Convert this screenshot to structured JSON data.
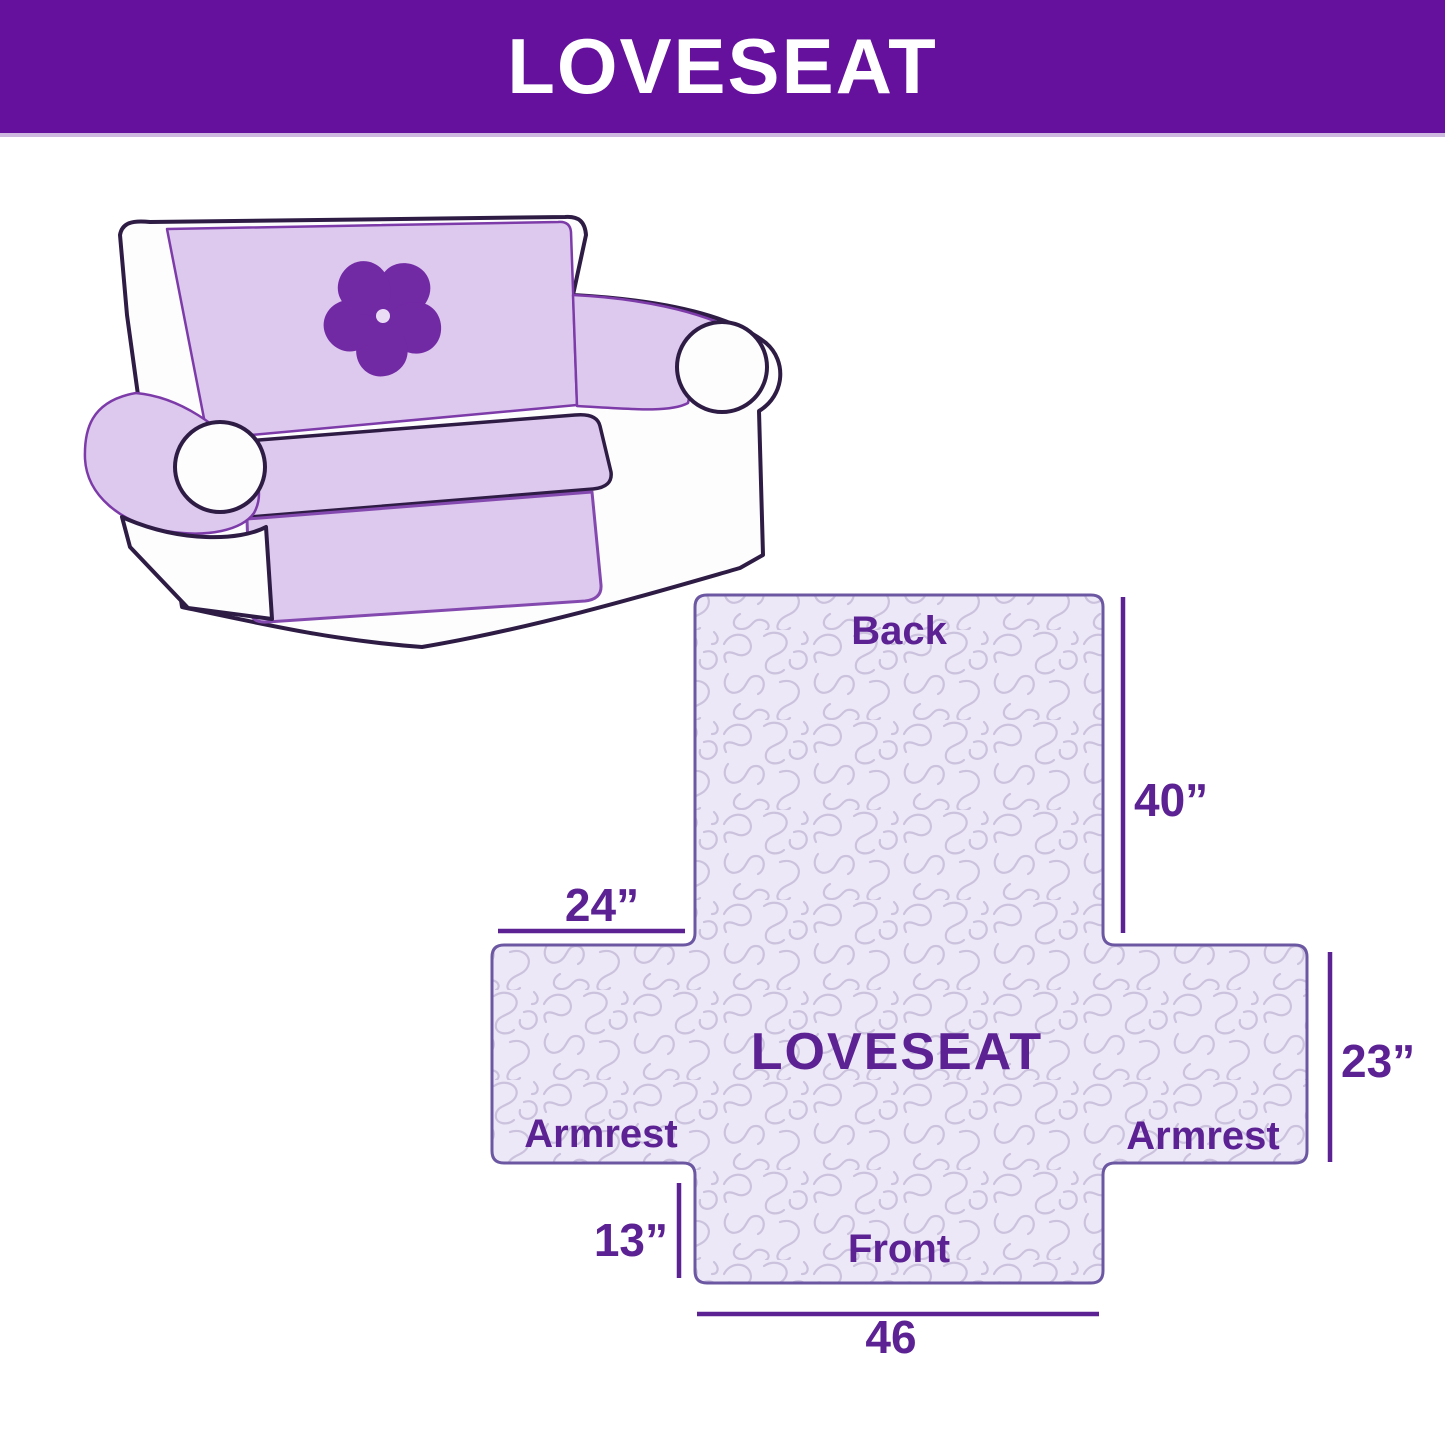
{
  "header": {
    "title": "LOVESEAT",
    "bg_color": "#66109E",
    "text_color": "#FFFFFF"
  },
  "illustration": {
    "description": "Loveseat sofa draped with quilted protective cover",
    "logo_icon": "pinwheel-icon",
    "cover_color": "#DDC8EE",
    "cover_edge_color": "#7C3BA8",
    "outline_color": "#2E1C45",
    "logo_color": "#7229A4"
  },
  "diagram": {
    "center_label": "LOVESEAT",
    "back_label": "Back",
    "front_label": "Front",
    "armrest_left_label": "Armrest",
    "armrest_right_label": "Armrest",
    "dim_back_height": "40”",
    "dim_armrest_top_width": "24”",
    "dim_armrest_side_height": "23”",
    "dim_front_flap_height": "13”",
    "dim_front_width": "46",
    "label_color": "#5C2294",
    "outline_color": "#6C58A2",
    "quilt_bg_color": "#EDE8F7",
    "quilt_line_color": "#CBC2DD"
  }
}
